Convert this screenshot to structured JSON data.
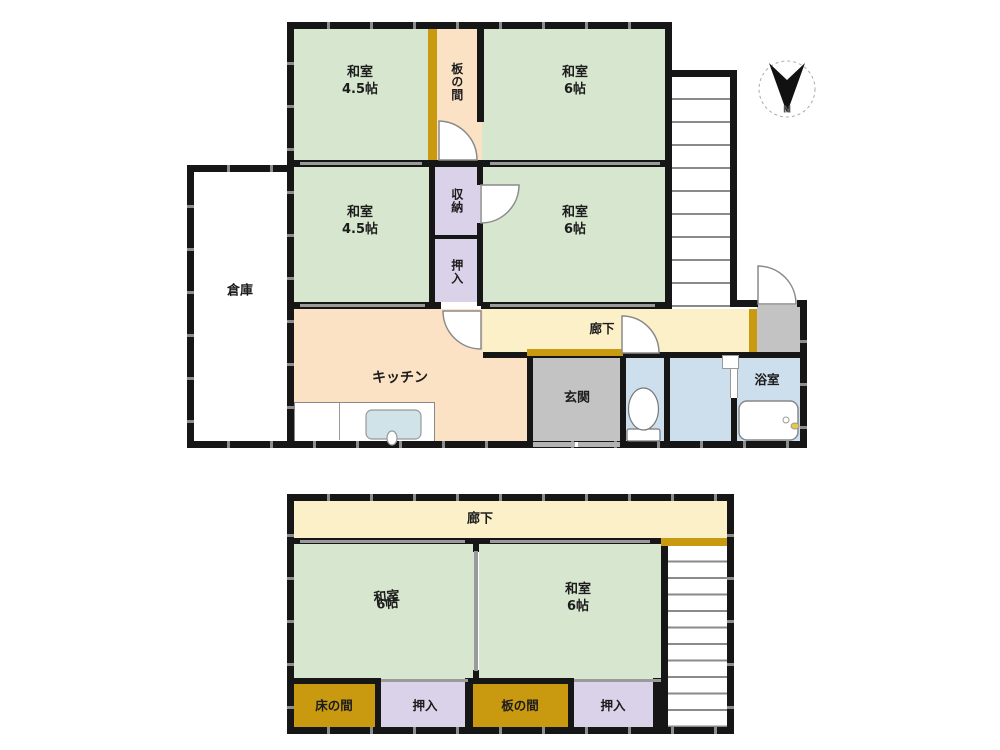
{
  "colors": {
    "wall": "#161616",
    "tatami_green": "#d7e6cf",
    "wood_peach": "#fbe2c5",
    "closet_lavender": "#d9d2e8",
    "hall_cream": "#fcf0c8",
    "threshold_gold": "#c9990f",
    "wet_blue": "#cddeed",
    "entry_gray": "#c3c3c3",
    "stair_line_gray": "#8a8a8a"
  },
  "compass": {
    "label": "N"
  },
  "upper_floor": {
    "rooms": {
      "washitsu_nw": {
        "label": "和室",
        "size": "4.5帖"
      },
      "itanoma": {
        "label": "板の間"
      },
      "washitsu_ne": {
        "label": "和室",
        "size": "6帖"
      },
      "washitsu_w": {
        "label": "和室",
        "size": "4.5帖"
      },
      "shuno": {
        "label": "収納"
      },
      "oshiire": {
        "label": "押入"
      },
      "washitsu_e": {
        "label": "和室",
        "size": "6帖"
      },
      "souko": {
        "label": "倉庫"
      },
      "kitchen": {
        "label": "キッチン"
      },
      "hallway": {
        "label": "廊下"
      },
      "genkan": {
        "label": "玄関"
      },
      "bathroom": {
        "label": "浴室"
      }
    }
  },
  "lower_floor": {
    "rooms": {
      "hallway": {
        "label": "廊下"
      },
      "washitsu_l": {
        "label": "和室",
        "size": "6帖"
      },
      "washitsu_r": {
        "label": "和室",
        "size": "6帖"
      },
      "tokonoma": {
        "label": "床の間"
      },
      "oshiire_l": {
        "label": "押入"
      },
      "itanoma": {
        "label": "板の間"
      },
      "oshiire_r": {
        "label": "押入"
      }
    }
  }
}
